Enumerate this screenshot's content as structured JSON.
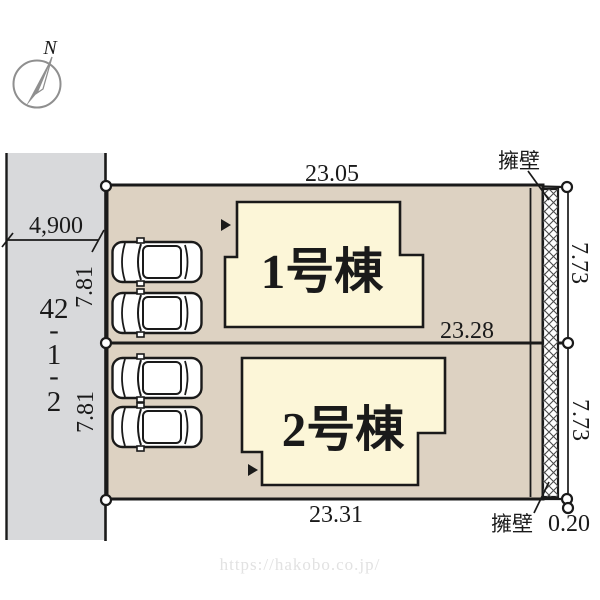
{
  "compass": {
    "north": "N"
  },
  "road": {
    "width": "4,900",
    "address": [
      "42",
      "-",
      "1",
      "-",
      "2"
    ],
    "frontage1": "7.81",
    "frontage2": "7.81"
  },
  "dims": {
    "lot1_top": "23.05",
    "lot1_bottom": "23.28",
    "lot2_bottom": "23.31",
    "lot1_right": "7.73",
    "lot2_right": "7.73",
    "wall_thickness": "0.20"
  },
  "buildings": {
    "b1": "1号棟",
    "b2": "2号棟"
  },
  "walls": {
    "top": "擁壁",
    "bottom": "擁壁"
  },
  "watermark": "https://hakobo.co.jp/",
  "colors": {
    "road": "#d8d9db",
    "lot": "#ddd2c2",
    "building": "#fcf6d8",
    "line": "#1a1a1a"
  }
}
